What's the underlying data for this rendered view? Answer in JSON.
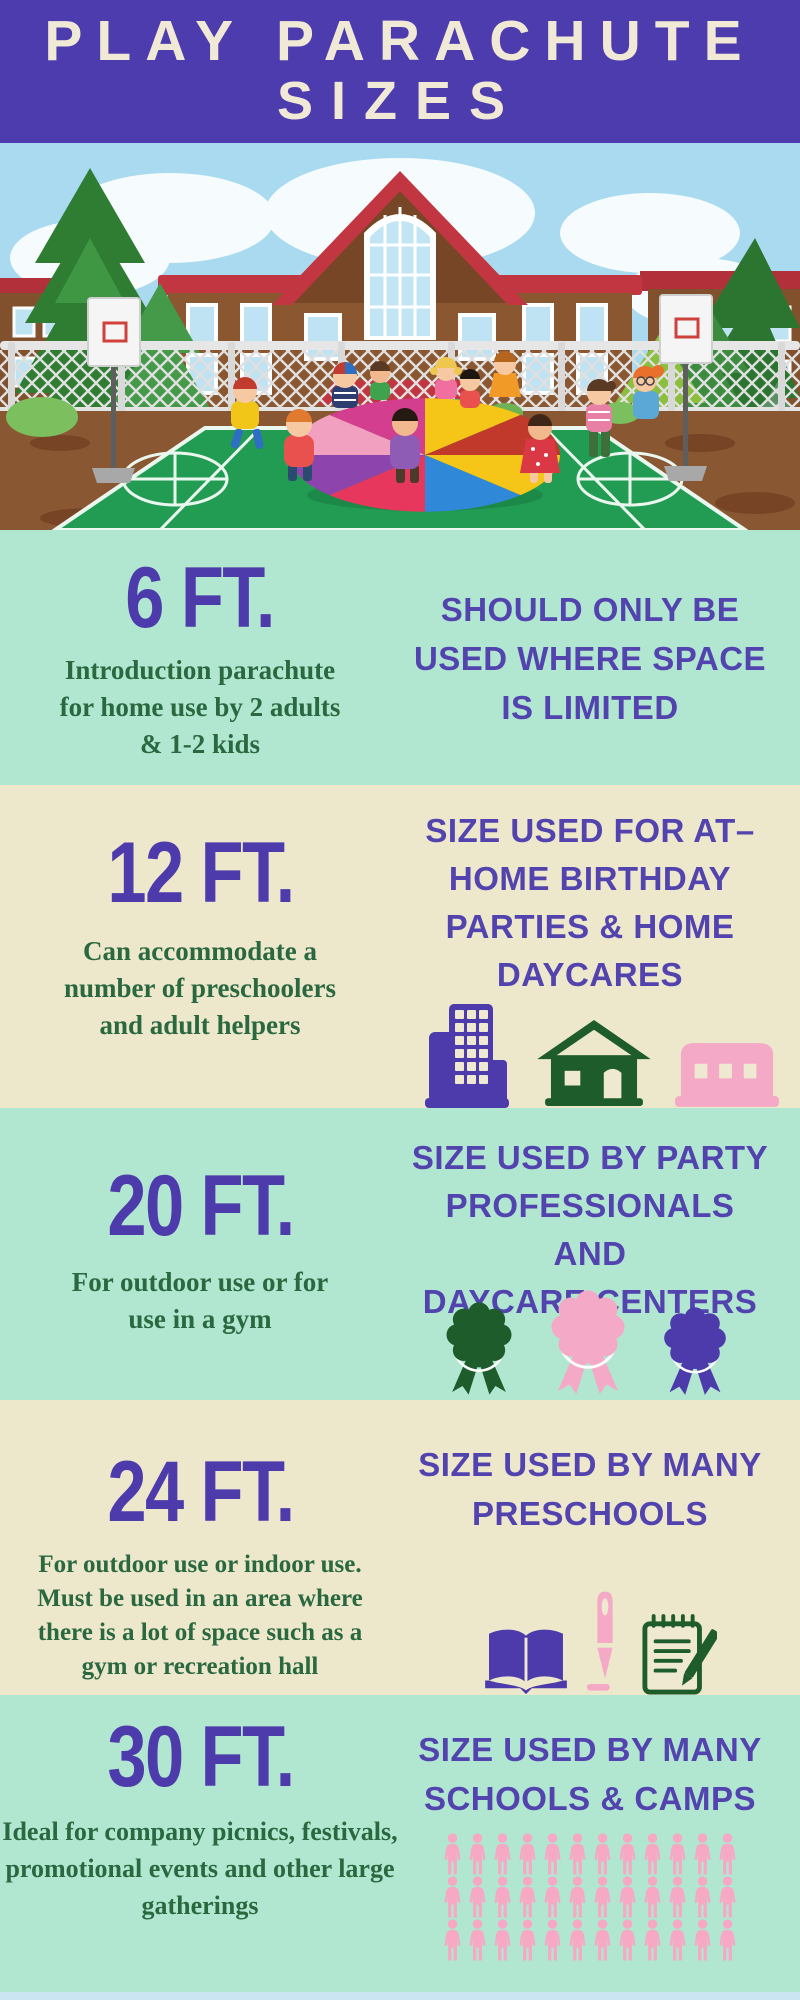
{
  "header": {
    "line1": "PLAY PARACHUTE",
    "line2": "SIZES"
  },
  "illustration": {
    "alt": "Kids playing with a colorful play parachute on a school basketball court"
  },
  "sections": [
    {
      "size": "6 FT.",
      "description_lines": [
        "Introduction parachute",
        "for home use by 2 adults",
        "& 1-2 kids"
      ],
      "heading_lines": [
        "SHOULD ONLY BE",
        "USED WHERE SPACE",
        "IS LIMITED"
      ],
      "icons": []
    },
    {
      "size": "12 FT.",
      "description_lines": [
        "Can accommodate a",
        "number of preschoolers",
        "and adult helpers"
      ],
      "heading_lines": [
        "SIZE USED FOR AT–",
        "HOME BIRTHDAY",
        "PARTIES & HOME",
        "DAYCARES"
      ],
      "icons": [
        "apartment-building",
        "house",
        "daycare-garage"
      ]
    },
    {
      "size": "20 FT.",
      "description_lines": [
        "For outdoor use or for",
        "use in a gym"
      ],
      "heading_lines": [
        "SIZE USED BY PARTY",
        "PROFESSIONALS AND",
        "DAYCARE CENTERS"
      ],
      "icons": [
        "rosette-green",
        "rosette-pink",
        "rosette-purple"
      ]
    },
    {
      "size": "24 FT.",
      "description_lines": [
        "For outdoor use or indoor use.",
        "Must be used in an area where",
        "there is a lot of space such as a",
        "gym or recreation hall"
      ],
      "heading_lines": [
        "SIZE USED BY MANY",
        "PRESCHOOLS"
      ],
      "icons": [
        "open-book",
        "pen",
        "notepad"
      ]
    },
    {
      "size": "30 FT.",
      "description_lines": [
        "Ideal for company picnics, festivals,",
        "promotional events and other large",
        "gatherings"
      ],
      "heading_lines": [
        "SIZE USED BY MANY",
        "SCHOOLS & CAMPS"
      ],
      "icons": [
        "crowd-pictogram"
      ],
      "crowd": {
        "rows": 3,
        "per_row": 12
      }
    }
  ],
  "colors": {
    "header_bg": "#4D3CAE",
    "purple": "#4D3BAC",
    "heading_purple": "#5243AE",
    "mint": "#B1E7D1",
    "cream": "#EDE7CB",
    "green_text": "#2A6840",
    "pink": "#F4A9C6",
    "icon_green": "#1E5C2B",
    "footer_strip": "#CBE6F2"
  }
}
